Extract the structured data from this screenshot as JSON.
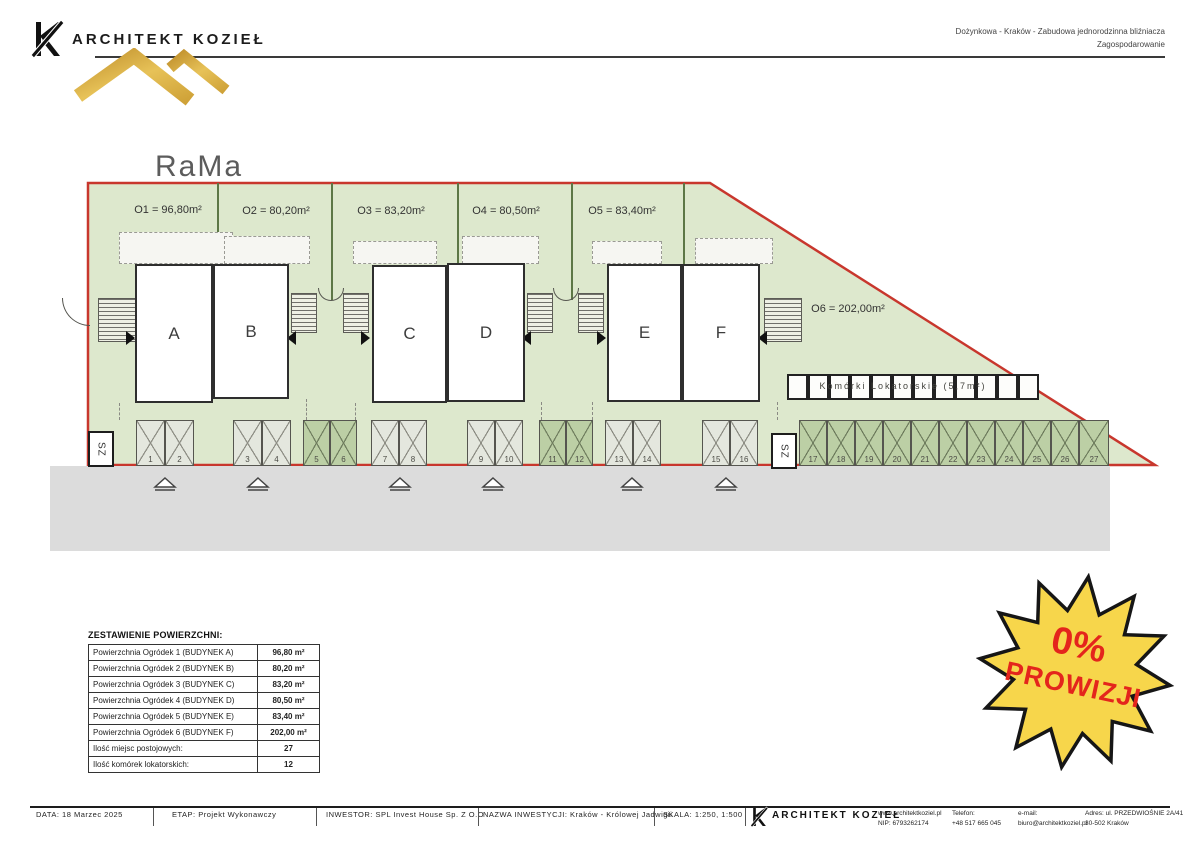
{
  "header": {
    "brand": "ARCHITEKT KOZIEŁ",
    "project_line1": "Dożynkowa - Kraków - Zabudowa jednorodzinna bliźniacza",
    "project_line2": "Zagospodarowanie"
  },
  "logo": {
    "line1": "RaMa",
    "line2": "HOME"
  },
  "plan": {
    "gardens": [
      {
        "label": "O1 = 96,80m²"
      },
      {
        "label": "O2 = 80,20m²"
      },
      {
        "label": "O3 = 83,20m²"
      },
      {
        "label": "O4 = 80,50m²"
      },
      {
        "label": "O5 = 83,40m²"
      },
      {
        "label": "O6 = 202,00m²"
      }
    ],
    "buildings": [
      {
        "label": "A"
      },
      {
        "label": "B"
      },
      {
        "label": "C"
      },
      {
        "label": "D"
      },
      {
        "label": "E"
      },
      {
        "label": "F"
      }
    ],
    "storage_label": "Komórki Lokatorskie (5,7m²)",
    "gate_label": "SZ",
    "parking_numbers": [
      "1",
      "2",
      "3",
      "4",
      "5",
      "6",
      "7",
      "8",
      "9",
      "10",
      "11",
      "12",
      "13",
      "14",
      "15",
      "16",
      "17",
      "18",
      "19",
      "20",
      "21",
      "22",
      "23",
      "24",
      "25",
      "26",
      "27"
    ]
  },
  "summary_table": {
    "title": "ZESTAWIENIE POWIERZCHNI:",
    "rows": [
      {
        "label": "Powierzchnia Ogródek 1 (BUDYNEK A)",
        "value": "96,80 m²"
      },
      {
        "label": "Powierzchnia Ogródek 2 (BUDYNEK B)",
        "value": "80,20 m²"
      },
      {
        "label": "Powierzchnia Ogródek 3 (BUDYNEK C)",
        "value": "83,20 m²"
      },
      {
        "label": "Powierzchnia Ogródek 4 (BUDYNEK D)",
        "value": "80,50 m²"
      },
      {
        "label": "Powierzchnia Ogródek 5 (BUDYNEK E)",
        "value": "83,40 m²"
      },
      {
        "label": "Powierzchnia Ogródek 6 (BUDYNEK F)",
        "value": "202,00 m²"
      },
      {
        "label": "Ilość miejsc postojowych:",
        "value": "27"
      },
      {
        "label": "Ilość komórek lokatorskich:",
        "value": "12"
      }
    ]
  },
  "badge": {
    "line1": "0%",
    "line2": "PROWIZJI"
  },
  "footer": {
    "date": "DATA: 18 Marzec 2025",
    "stage": "ETAP: Projekt Wykonawczy",
    "investor": "INWESTOR: SPL Invest House Sp. Z O.O",
    "investment": "NAZWA INWESTYCJI: Kraków - Królowej Jadwigii",
    "scale": "SKALA: 1:250, 1:500",
    "brand": "ARCHITEKT KOZIEŁ",
    "website": "www.architektkoziel.pl",
    "nip": "NIP: 6793262174",
    "phone_label": "Telefon:",
    "phone": "+48 517 665 045",
    "email_label": "e-mail:",
    "email": "biuro@architektkoziel.pl",
    "address_line1": "Adres: ul. PRZEDWIOŚNIE 2A/41",
    "address_line2": "30-502 Kraków"
  },
  "colors": {
    "site_green": "#dde8cd",
    "dark_cell_green": "#bccfa5",
    "boundary_red": "#c8372d",
    "badge_yellow": "#f7d64b",
    "badge_red": "#e4251c",
    "logo_gold": "#d3a43b"
  }
}
